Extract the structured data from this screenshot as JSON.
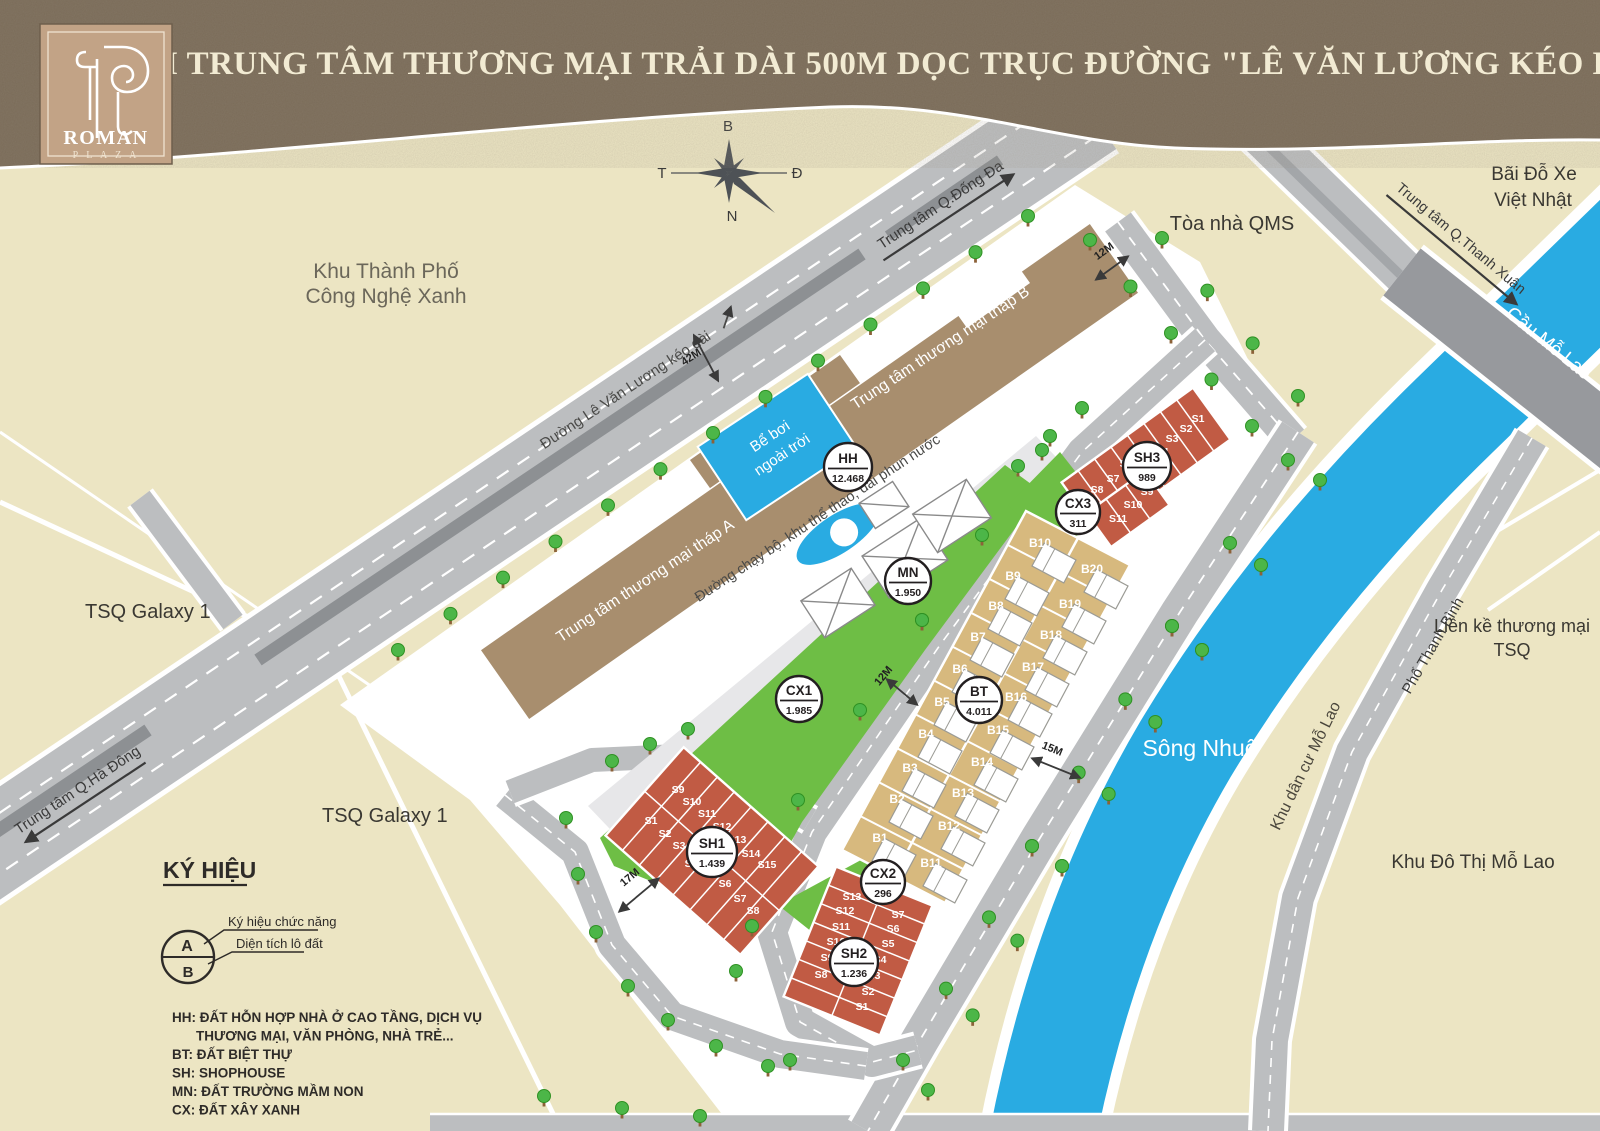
{
  "title": "KHỐI TRUNG TÂM THƯƠNG MẠI TRẢI DÀI 500M DỌC TRỤC ĐƯỜNG \"LÊ VĂN LƯƠNG KÉO DÀI\"",
  "logo": {
    "name": "ROMAN",
    "subname": "P L A Z A"
  },
  "compass": {
    "n": "B",
    "e": "Đ",
    "w": "T",
    "s": "N"
  },
  "roads": {
    "le_van_luong": "Đường Lê Văn Lương kéo dài",
    "dong_da": "Trung tâm Q.Đống Đa",
    "ha_dong": "Trung tâm Q.Hà Đông",
    "thanh_xuan": "Trung tâm Q.Thanh Xuân",
    "thanh_binh": "Phố Thanh Bình",
    "mo_lao_bridge": "Cầu Mỗ Lao",
    "jogging_path": "Đường chạy bộ, khu thể thao, đài phun nước"
  },
  "dimensions": {
    "d42": "42M",
    "d12a": "12M",
    "d12b": "12M",
    "d15": "15M",
    "d17": "17M"
  },
  "neighbors": {
    "green_tech_1": "Khu Thành Phố",
    "green_tech_2": "Công Nghệ Xanh",
    "tsq_a": "TSQ Galaxy 1",
    "tsq_b": "TSQ Galaxy 1",
    "qms": "Tòa nhà QMS",
    "parking_1": "Bãi Đỗ Xe",
    "parking_2": "Việt Nhật",
    "lien_ke_1": "Liền kề thương mại",
    "lien_ke_2": "TSQ",
    "khu_dan_cu": "Khu dân cư Mỗ Lao",
    "khu_do_thi": "Khu Đô Thị Mỗ Lao",
    "river": "Sông Nhuệ"
  },
  "site": {
    "tower_a": "Trung tâm thương mại tháp A",
    "tower_b": "Trung tâm thương mại tháp B",
    "pool_1": "Bể bơi",
    "pool_2": "ngoài trời"
  },
  "badges": [
    {
      "code": "HH",
      "value": "12.468"
    },
    {
      "code": "MN",
      "value": "1.950"
    },
    {
      "code": "CX1",
      "value": "1.985"
    },
    {
      "code": "CX2",
      "value": "296"
    },
    {
      "code": "CX3",
      "value": "311"
    },
    {
      "code": "BT",
      "value": "4.011"
    },
    {
      "code": "SH1",
      "value": "1.439"
    },
    {
      "code": "SH2",
      "value": "1.236"
    },
    {
      "code": "SH3",
      "value": "989"
    }
  ],
  "lots": {
    "bt": [
      "B1",
      "B2",
      "B3",
      "B4",
      "B5",
      "B6",
      "B7",
      "B8",
      "B9",
      "B10",
      "B11",
      "B12",
      "B13",
      "B14",
      "B15",
      "B16",
      "B17",
      "B18",
      "B19",
      "B20"
    ],
    "sh1": [
      "S1",
      "S2",
      "S3",
      "S4",
      "S5",
      "S6",
      "S7",
      "S8",
      "S9",
      "S10",
      "S11",
      "S12",
      "S13",
      "S14",
      "S15"
    ],
    "sh2": [
      "S1",
      "S2",
      "S3",
      "S4",
      "S5",
      "S6",
      "S7",
      "S8",
      "S9",
      "S10",
      "S11",
      "S12",
      "S13"
    ],
    "sh3": [
      "S1",
      "S2",
      "S3",
      "S4",
      "S5",
      "S6",
      "S7",
      "S8",
      "S9",
      "S10",
      "S11"
    ]
  },
  "legend": {
    "title": "KÝ HIỆU",
    "sym_a": "A",
    "sym_b": "B",
    "callout_a": "Ký hiệu chức năng",
    "callout_b": "Diện tích lô đất",
    "items": [
      "HH: ĐẤT HỖN HỢP NHÀ Ở CAO TẦNG, DỊCH VỤ",
      "THƯƠNG MẠI, VĂN PHÒNG, NHÀ TRẺ...",
      "BT: ĐẤT BIỆT THỰ",
      "SH: SHOPHOUSE",
      "MN: ĐẤT TRƯỜNG MẦM NON",
      "CX: ĐẤT XÂY XANH"
    ]
  },
  "colors": {
    "water_blue": "#29ABE2",
    "green": "#6EBE45",
    "shophouse_red": "#C15B44",
    "villa_tan": "#D7B97E",
    "building_brown": "#A88E6E",
    "road_gray": "#BCBEC0",
    "header_brown": "#7A6B58",
    "map_beige": "#ECE5C3"
  }
}
